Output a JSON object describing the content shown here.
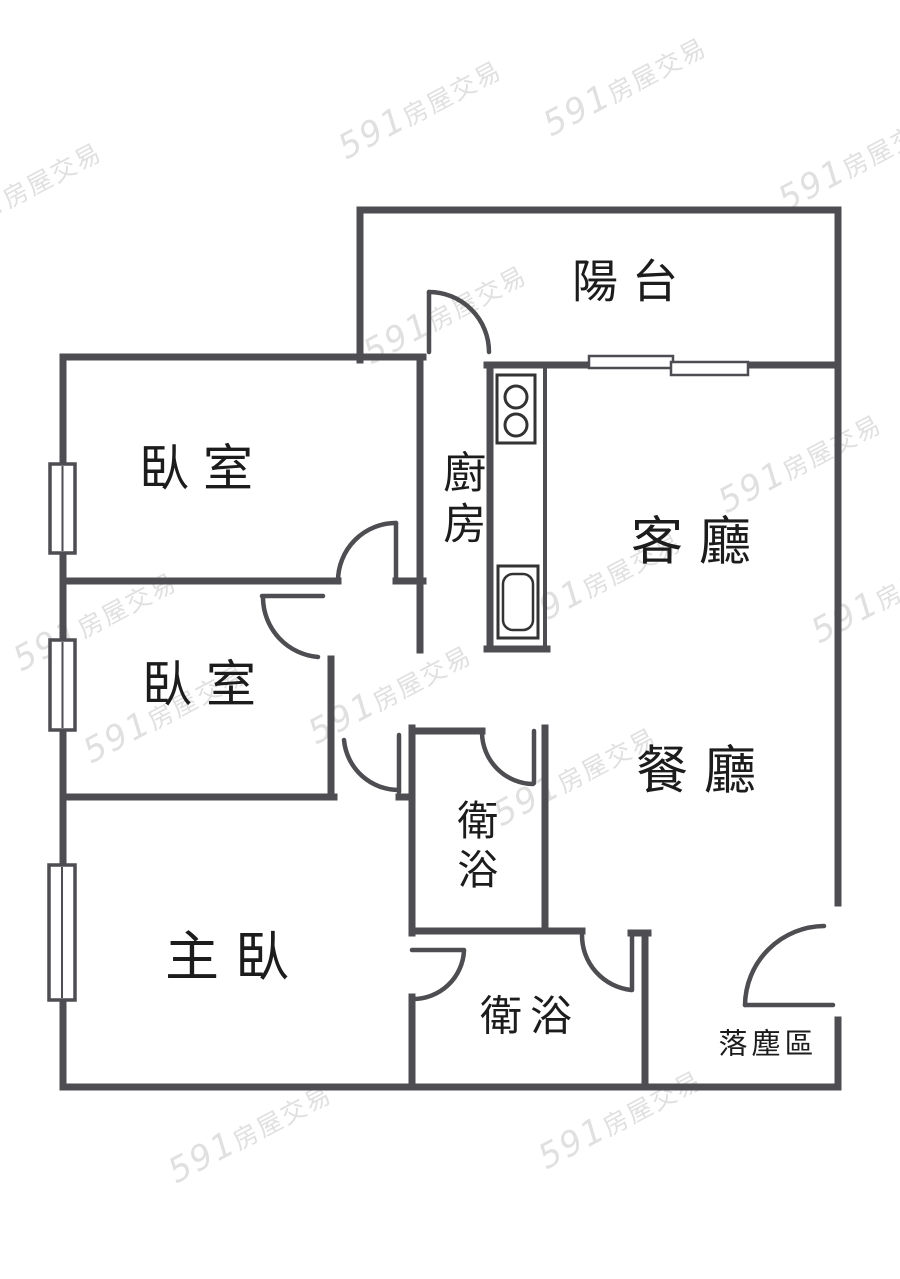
{
  "floorplan": {
    "rooms": {
      "balcony": {
        "label": "陽台"
      },
      "kitchen": {
        "label": "廚房"
      },
      "living_room": {
        "label": "客廳"
      },
      "dining_room": {
        "label": "餐廳"
      },
      "bedroom_1": {
        "label": "臥室"
      },
      "bedroom_2": {
        "label": "臥室"
      },
      "master_bedroom": {
        "label": "主臥"
      },
      "bathroom_1": {
        "label": "衛浴"
      },
      "bathroom_2": {
        "label": "衛浴"
      },
      "entry_zone": {
        "label": "落塵區"
      }
    },
    "colors": {
      "wall": "#4d4d52",
      "label_text": "#1c1c1c",
      "watermark": "#e0e0e0",
      "background": "#ffffff"
    },
    "watermark": {
      "brand": "591",
      "suffix": "房屋交易",
      "positions": [
        [
          20,
          190
        ],
        [
          420,
          108
        ],
        [
          625,
          85
        ],
        [
          860,
          160
        ],
        [
          445,
          313
        ],
        [
          800,
          462
        ],
        [
          95,
          620
        ],
        [
          600,
          580
        ],
        [
          893,
          592
        ],
        [
          165,
          712
        ],
        [
          390,
          693
        ],
        [
          575,
          775
        ],
        [
          250,
          1132
        ],
        [
          620,
          1118
        ]
      ]
    }
  }
}
